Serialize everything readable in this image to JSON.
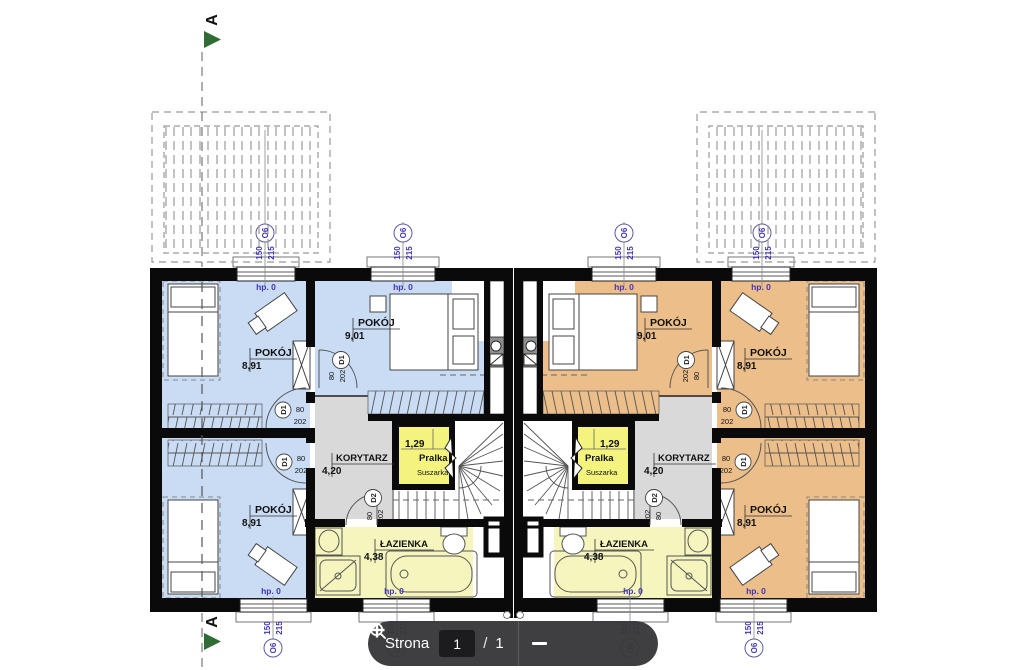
{
  "document": {
    "type": "floor-plan",
    "title_visible": false
  },
  "section_marker": {
    "label": "A"
  },
  "labels": {
    "floor_level": "hp. 0",
    "window": {
      "code": "O6",
      "width": "150",
      "height": "215"
    },
    "door1": {
      "code": "D1",
      "width": "80",
      "height": "202"
    },
    "door2": {
      "code": "D2",
      "width": "80",
      "height": "202"
    }
  },
  "units": {
    "left": {
      "rooms": {
        "room_top_left": {
          "name": "POKÓJ",
          "area": "8,91"
        },
        "room_top_mid": {
          "name": "POKÓJ",
          "area": "9,01"
        },
        "room_bottom_left": {
          "name": "POKÓJ",
          "area": "8,91"
        },
        "corridor": {
          "name": "KORYTARZ",
          "area": "4,20"
        },
        "laundry": {
          "name": "Pralka",
          "name2": "Suszarka",
          "area": "1,29"
        },
        "bathroom": {
          "name": "ŁAZIENKA",
          "area": "4,38"
        }
      }
    },
    "right": {
      "rooms": {
        "room_top_left": {
          "name": "POKÓJ",
          "area": "8,91"
        },
        "room_top_mid": {
          "name": "POKÓJ",
          "area": "9,01"
        },
        "room_bottom_left": {
          "name": "POKÓJ",
          "area": "8,91"
        },
        "corridor": {
          "name": "KORYTARZ",
          "area": "4,20"
        },
        "laundry": {
          "name": "Pralka",
          "name2": "Suszarka",
          "area": "1,29"
        },
        "bathroom": {
          "name": "ŁAZIENKA",
          "area": "4,38"
        }
      }
    }
  },
  "toolbar": {
    "page_label": "Strona",
    "page_value": "1",
    "page_separator": "/",
    "page_total": "1"
  },
  "colors": {
    "unit_left_room": "#c9dcf4",
    "unit_right_room": "#ecbe8a",
    "corridor": "#d9d9d9",
    "laundry": "#f3f37e",
    "bathroom": "#f5f5bd",
    "wall": "#0a0a0a",
    "marker_text": "#3f35b5",
    "section_arrow": "#2f6d35",
    "toolbar_bg": "#37373a"
  }
}
